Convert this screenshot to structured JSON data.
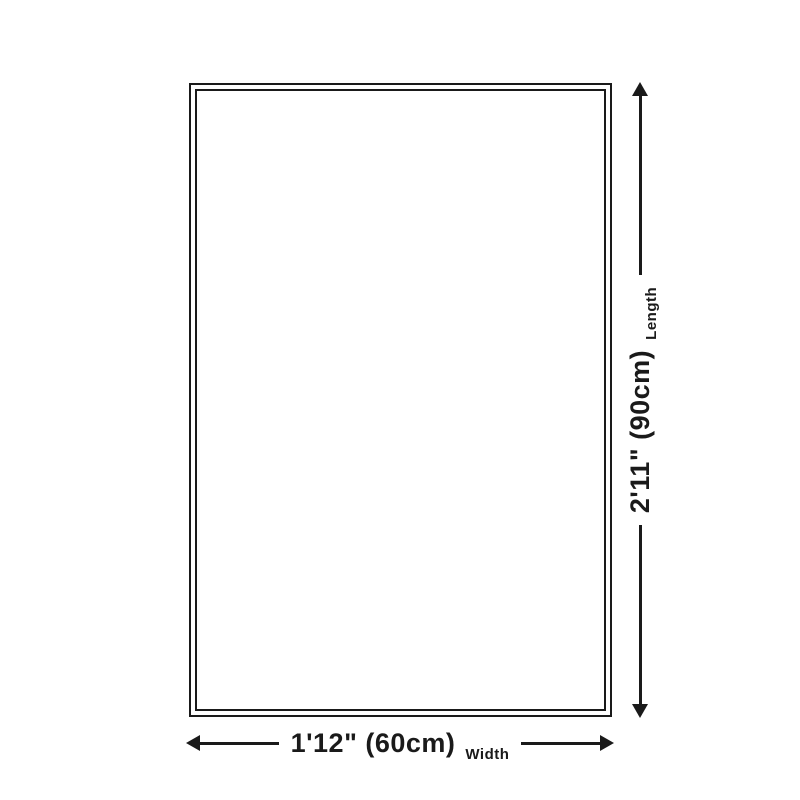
{
  "diagram": {
    "width": {
      "value": "1'12\" (60cm)",
      "axis_label": "Width"
    },
    "length": {
      "value": "2'11\" (90cm)",
      "axis_label": "Length"
    },
    "colors": {
      "line": "#1a1a1a",
      "background": "#ffffff"
    }
  }
}
